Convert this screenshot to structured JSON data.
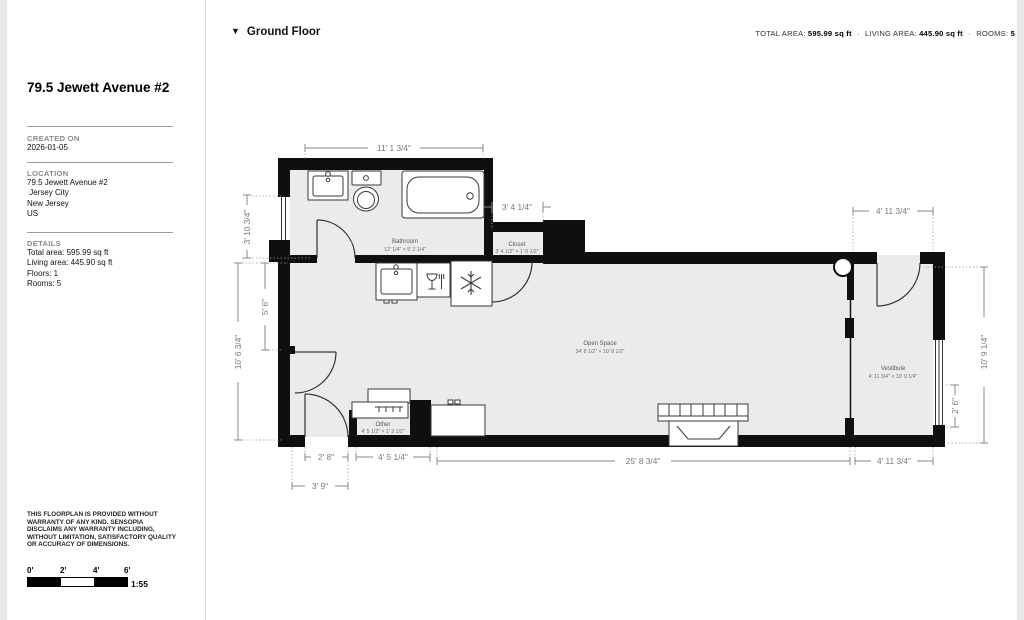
{
  "sidebar": {
    "title": "79.5 Jewett Avenue #2",
    "created_label": "CREATED ON",
    "created_value": "2026-01-05",
    "location_label": "LOCATION",
    "location_lines": [
      "79.5 Jewett Avenue #2",
      " Jersey City",
      "New Jersey",
      "US"
    ],
    "details_label": "DETAILS",
    "details_lines": [
      "Total area: 595.99 sq ft",
      "Living area: 445.90 sq ft",
      "Floors: 1",
      "Rooms: 5"
    ],
    "disclaimer": "THIS FLOORPLAN IS PROVIDED WITHOUT WARRANTY OF ANY KIND. SENSOPIA DISCLAIMS ANY WARRANTY INCLUDING, WITHOUT LIMITATION, SATISFACTORY QUALITY OR ACCURACY OF DIMENSIONS.",
    "scale": {
      "ticks": [
        "0'",
        "2'",
        "4'",
        "6'"
      ],
      "ratio": "1:55"
    }
  },
  "header": {
    "floor_label": "Ground Floor",
    "separator": "·",
    "stats": [
      {
        "label": "TOTAL AREA:",
        "value": "595.99 sq ft"
      },
      {
        "label": "LIVING AREA:",
        "value": "445.90 sq ft"
      },
      {
        "label": "ROOMS:",
        "value": "5"
      }
    ]
  },
  "plan": {
    "rooms": {
      "bathroom": {
        "name": "Bathroom",
        "dims": "12' 1/4\" × 5' 2 1/4\""
      },
      "closet": {
        "name": "Closet",
        "dims": "3' 4 1/2\" × 1' 6 1/2\""
      },
      "open_space": {
        "name": "Open Space",
        "dims": "34' 8 1/2\" × 10' 8 1/2\""
      },
      "vestibule": {
        "name": "Vestibule",
        "dims": "4' 11 3/4\" × 10' 9 1/4\""
      },
      "other": {
        "name": "Other",
        "dims": "4' 5 1/2\" × 1' 3 1/2\""
      }
    },
    "dimensions": {
      "top_bathroom": "11' 1 3/4\"",
      "top_closet": "3' 4 1/4\"",
      "top_vestibule": "4' 11 3/4\"",
      "left_window": "3' 10 3/4\"",
      "left_inner": "5' 6\"",
      "left_overall": "10' 6 3/4\"",
      "right_window": "2' 6\"",
      "right_overall": "10' 9 1/4\"",
      "bottom_door": "2' 8\"",
      "bottom_entry": "3' 9\"",
      "bottom_other": "4' 5 1/4\"",
      "bottom_open": "25' 8 3/4\"",
      "bottom_vestibule": "4' 11 3/4\""
    }
  }
}
